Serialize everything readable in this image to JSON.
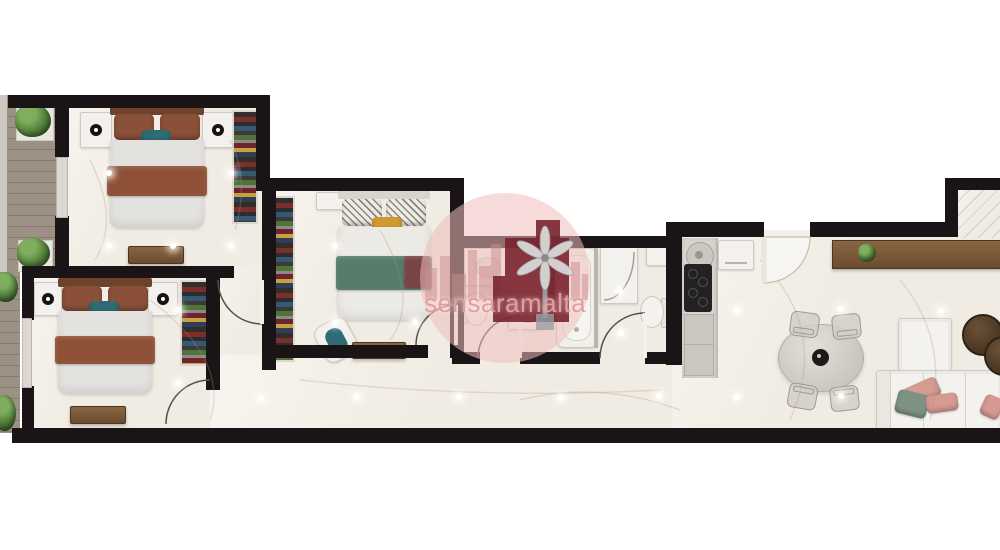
{
  "watermark": {
    "text": "sensaramalta",
    "logo_icon": "windmill-icon"
  },
  "colors": {
    "wall": "#1a1416",
    "floor": "#f1ece3",
    "deck_wood": "#9c9184",
    "deck_line": "#857b6f",
    "duvet": "#e4e2de",
    "headboard_brown": "#6e432c",
    "pillow_brown": "#8a5038",
    "accent_teal": "#2f6b74",
    "pillow_mustard": "#cf9a2f",
    "blanket_brown": "#8e5138",
    "blanket_green": "#567c6b",
    "fixture_white": "#f3f1ed",
    "cooktop_black": "#242122",
    "sofa_white": "#f4f2ee",
    "cushion_pink": "#d59a92",
    "cushion_green": "#7e9283",
    "coffee_table_brown": "#4a3522",
    "plant_green": "#55813c",
    "watermark_pink": "#eebdbc",
    "watermark_red": "#77202b",
    "watermark_text_pink": "#e49c9c"
  }
}
